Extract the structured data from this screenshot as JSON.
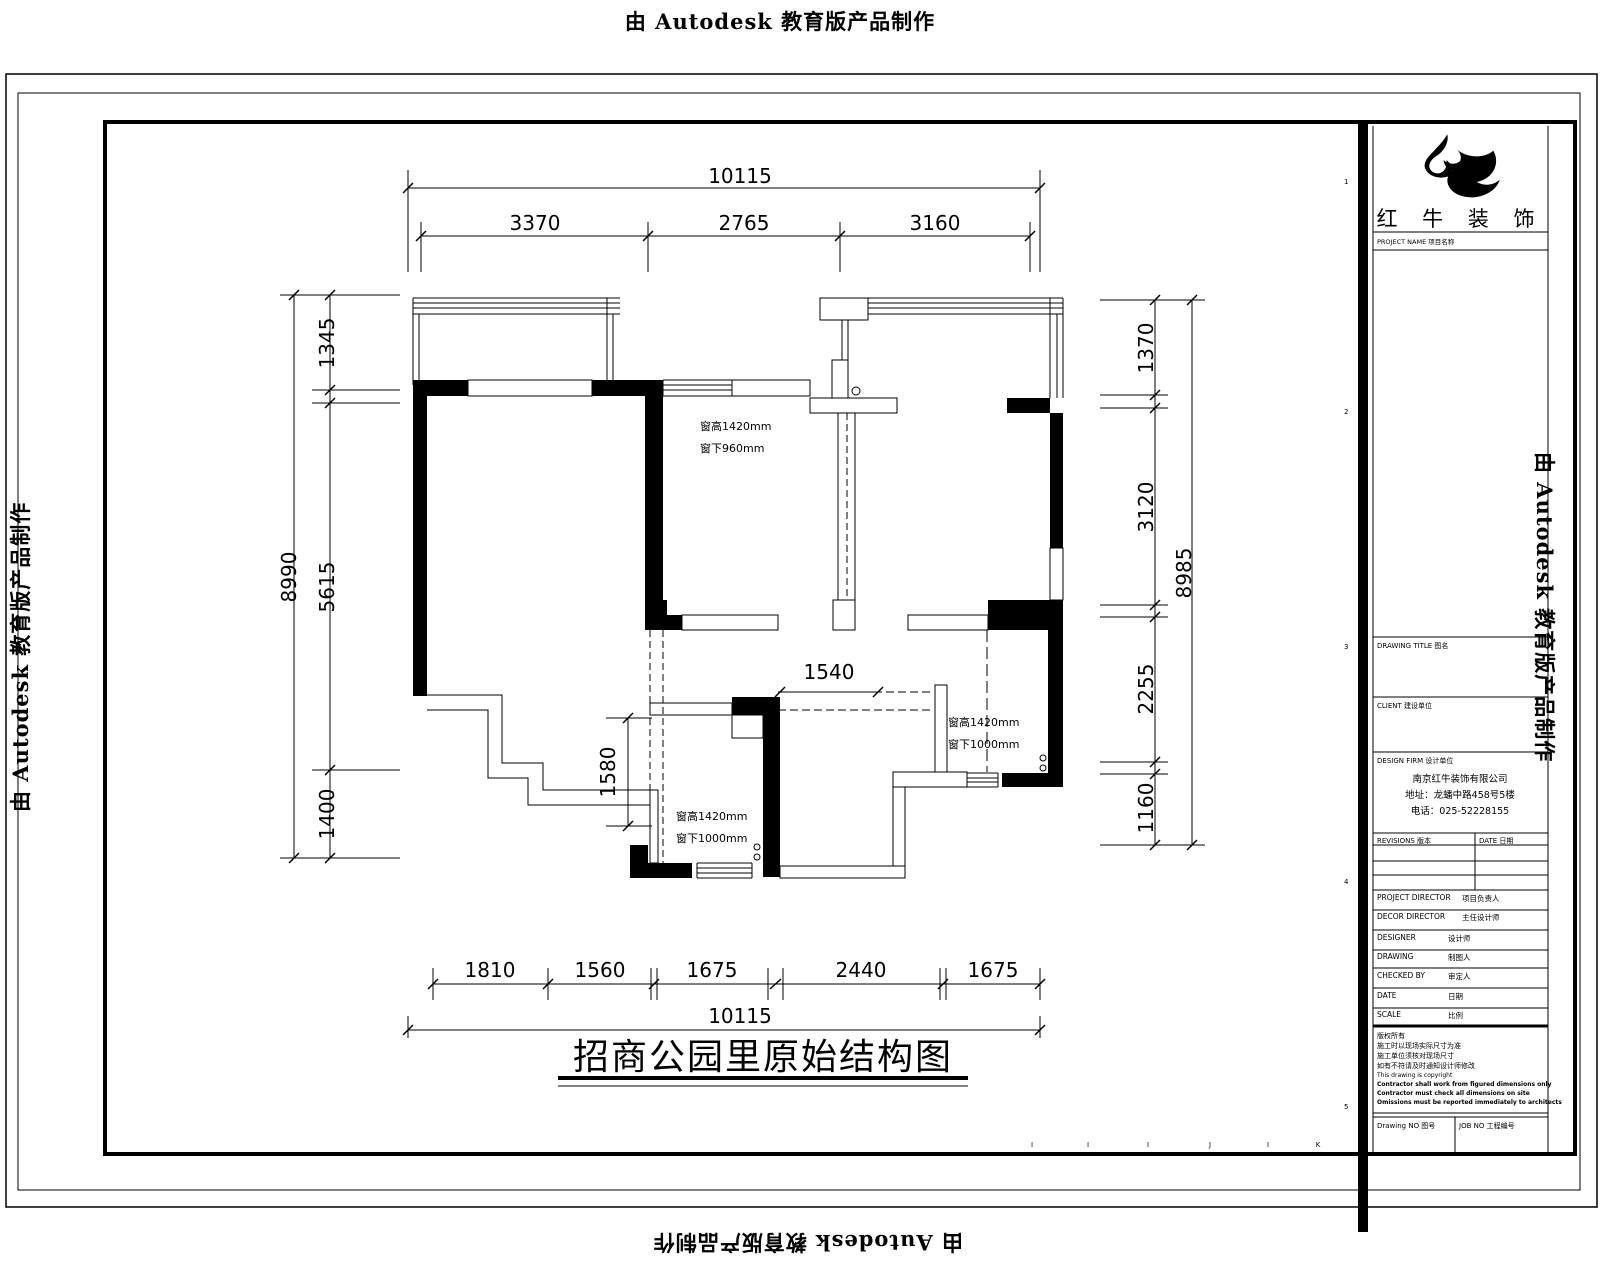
{
  "watermark": {
    "text": "由 Autodesk 教育版产品制作"
  },
  "main_title": {
    "text": "招商公园里原始结构图"
  },
  "dims": {
    "top": {
      "overall": "10115",
      "segments": [
        "3370",
        "2765",
        "3160"
      ]
    },
    "bottom": {
      "overall": "10115",
      "segments": [
        "1810",
        "1560",
        "1675",
        "2440",
        "1675"
      ]
    },
    "left": {
      "overall": "8990",
      "segments": [
        "1345",
        "5615",
        "1400"
      ]
    },
    "right": {
      "overall": "8985",
      "segments": [
        "1370",
        "3120",
        "2255",
        "1160"
      ]
    },
    "interior": {
      "width": "1540",
      "height": "1580"
    }
  },
  "annotations": {
    "window_top": {
      "line1": "窗高1420mm",
      "line2": "窗下960mm"
    },
    "window_right": {
      "line1": "窗高1420mm",
      "line2": "窗下1000mm"
    },
    "window_bottom": {
      "line1": "窗高1420mm",
      "line2": "窗下1000mm"
    }
  },
  "title_block": {
    "logo_text": "红 牛 装 饰",
    "logo_caption": "PROJECT NAME 项目名称",
    "drawing_title_label": "DRAWING TITLE 图名",
    "client_label": "CLIENT 建设单位",
    "design_firm_label": "DESIGN FIRM 设计单位",
    "company": [
      "南京红牛装饰有限公司",
      "地址：龙蟠中路458号5楼",
      "电话：025-52228155"
    ],
    "revisions_label": "REVISIONS 版本",
    "date_col_label": "DATE 日期",
    "rows": [
      {
        "en": "PROJECT DIRECTOR",
        "cn": "项目负责人"
      },
      {
        "en": "DECOR DIRECTOR",
        "cn": "主任设计师"
      },
      {
        "en": "DESIGNER",
        "cn": "设计师"
      },
      {
        "en": "DRAWING",
        "cn": "制图人"
      },
      {
        "en": "CHECKED BY",
        "cn": "审定人"
      },
      {
        "en": "DATE",
        "cn": "日期"
      },
      {
        "en": "SCALE",
        "cn": "比例"
      }
    ],
    "notes": [
      "版权所有",
      "施工时以现场实际尺寸为准",
      "施工单位须核对现场尺寸",
      "如有不符请及时通知设计师修改",
      "This drawing is copyright",
      "Contractor shall work from figured dimensions only",
      "Contractor must check all dimensions on site",
      "Omissions must be reported immediately to architects"
    ],
    "drawing_no_label": "Drawing NO 图号",
    "job_no_label": "JOB NO 工程编号"
  },
  "grid_refs": {
    "bottom_letters": [
      "I",
      "I",
      "I",
      "J",
      "I",
      "K"
    ],
    "side_numbers": [
      "1",
      "2",
      "3",
      "4",
      "5"
    ]
  }
}
